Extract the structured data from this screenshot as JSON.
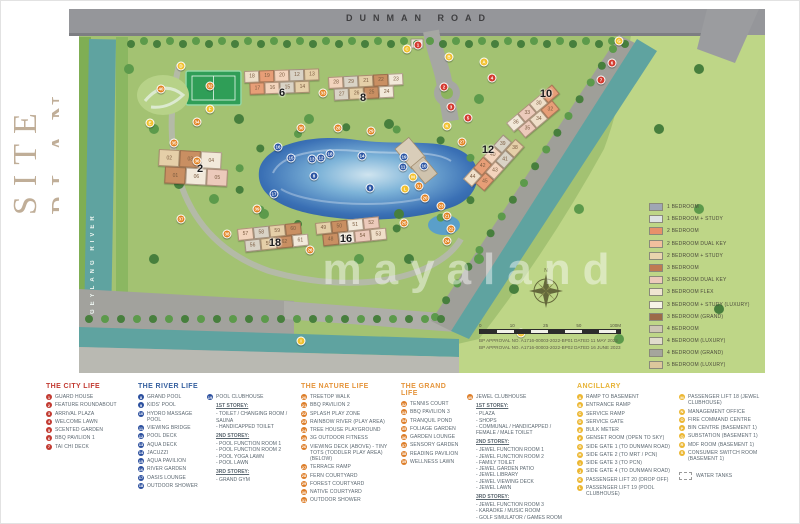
{
  "title": "SITE PLAN",
  "map": {
    "road_label": "DUNMAN ROAD",
    "river_label": "GEYLANG RIVER",
    "watermark": "mayaland",
    "scale_ticks": [
      "0",
      "10",
      "25",
      "50",
      "100M"
    ],
    "approval_lines": [
      "BP APPROVAL NO. A1716-00003-2022-BP01 DATED 11 MAY 2023",
      "BP APPROVAL NO. A1716-00003-2022-BP02 DATED 16 JUNE 2023"
    ],
    "unit_legend": [
      {
        "label": "1 BEDROOM",
        "color": "#9fa6b4"
      },
      {
        "label": "1 BEDROOM + STUDY",
        "color": "#dde2e3"
      },
      {
        "label": "2 BEDROOM",
        "color": "#e8906a"
      },
      {
        "label": "2 BEDROOM DUAL KEY",
        "color": "#f2bf9e"
      },
      {
        "label": "2 BEDROOM + STUDY",
        "color": "#e9d4ae"
      },
      {
        "label": "3 BEDROOM",
        "color": "#bf7a52"
      },
      {
        "label": "3 BEDROOM DUAL KEY",
        "color": "#eccabb"
      },
      {
        "label": "3 BEDROOM FLEX",
        "color": "#efe5d2"
      },
      {
        "label": "3 BEDROOM + STUDY (LUXURY)",
        "color": "#f7f3e8"
      },
      {
        "label": "3 BEDROOM (GRAND)",
        "color": "#9c6b49"
      },
      {
        "label": "4 BEDROOM",
        "color": "#cdc6b4"
      },
      {
        "label": "4 BEDROOM (LUXURY)",
        "color": "#e0dccc"
      },
      {
        "label": "4 BEDROOM (GRAND)",
        "color": "#a5a59d"
      },
      {
        "label": "5 BEDROOM (LUXURY)",
        "color": "#dcc79c"
      },
      {
        "label": "5 BEDROOM (GRAND)",
        "color": "#c8a469"
      },
      {
        "label": "PENTHOUSE",
        "color": "#f1e5ab"
      }
    ],
    "block_labels": [
      {
        "text": "2",
        "x": 141,
        "y": 160
      },
      {
        "text": "6",
        "x": 223,
        "y": 84
      },
      {
        "text": "8",
        "x": 304,
        "y": 89
      },
      {
        "text": "10",
        "x": 487,
        "y": 85
      },
      {
        "text": "12",
        "x": 429,
        "y": 141
      },
      {
        "text": "18",
        "x": 216,
        "y": 234
      },
      {
        "text": "16",
        "x": 287,
        "y": 230
      }
    ],
    "towers": [
      {
        "x": 185,
        "y": 62,
        "rot": -2,
        "bw": 15,
        "bh": 12,
        "rows": [
          [
            "18",
            "19",
            "20",
            "12",
            "13"
          ],
          [
            "17",
            "16",
            "15",
            "14"
          ]
        ]
      },
      {
        "x": 269,
        "y": 68,
        "rot": -3,
        "bw": 15,
        "bh": 12,
        "rows": [
          [
            "28",
            "29",
            "21",
            "22",
            "23"
          ],
          [
            "27",
            "26",
            "25",
            "24"
          ]
        ]
      },
      {
        "x": 100,
        "y": 140,
        "rot": 3,
        "bw": 21,
        "bh": 17,
        "rows": [
          [
            "02",
            "03",
            "04"
          ],
          [
            "01",
            "06",
            "05"
          ]
        ]
      },
      {
        "x": 447,
        "y": 114,
        "rot": -40,
        "bw": 15,
        "bh": 12,
        "rows": [
          [
            "36",
            "33",
            "30",
            "31"
          ],
          [
            "35",
            "34",
            "32"
          ]
        ]
      },
      {
        "x": 404,
        "y": 170,
        "rot": -48,
        "bw": 15,
        "bh": 12,
        "rows": [
          [
            "44",
            "42",
            "40",
            "39"
          ],
          [
            "45",
            "43",
            "41",
            "38"
          ]
        ]
      },
      {
        "x": 178,
        "y": 220,
        "rot": -6,
        "bw": 16,
        "bh": 12,
        "rows": [
          [
            "57",
            "58",
            "59",
            "60"
          ],
          [
            "56",
            "55",
            "62",
            "61"
          ]
        ]
      },
      {
        "x": 256,
        "y": 214,
        "rot": -6,
        "bw": 16,
        "bh": 12,
        "rows": [
          [
            "49",
            "50",
            "51",
            "52"
          ],
          [
            "48",
            "47",
            "54",
            "53"
          ]
        ]
      }
    ],
    "markers": [
      {
        "c": "r",
        "t": "1",
        "x": 359,
        "y": 36
      },
      {
        "c": "r",
        "t": "2",
        "x": 385,
        "y": 78
      },
      {
        "c": "r",
        "t": "3",
        "x": 392,
        "y": 98
      },
      {
        "c": "r",
        "t": "4",
        "x": 433,
        "y": 69
      },
      {
        "c": "r",
        "t": "5",
        "x": 409,
        "y": 109
      },
      {
        "c": "r",
        "t": "6",
        "x": 553,
        "y": 54
      },
      {
        "c": "r",
        "t": "7",
        "x": 542,
        "y": 71
      },
      {
        "c": "b",
        "t": "8",
        "x": 255,
        "y": 167
      },
      {
        "c": "b",
        "t": "9",
        "x": 311,
        "y": 179
      },
      {
        "c": "b",
        "t": "10",
        "x": 365,
        "y": 157
      },
      {
        "c": "b",
        "t": "11",
        "x": 344,
        "y": 158
      },
      {
        "c": "b",
        "t": "12",
        "x": 262,
        "y": 149
      },
      {
        "c": "b",
        "t": "13",
        "x": 253,
        "y": 150
      },
      {
        "c": "b",
        "t": "14",
        "x": 303,
        "y": 147
      },
      {
        "c": "b",
        "t": "15",
        "x": 232,
        "y": 149
      },
      {
        "c": "b",
        "t": "16",
        "x": 219,
        "y": 138
      },
      {
        "c": "b",
        "t": "17",
        "x": 215,
        "y": 185
      },
      {
        "c": "b",
        "t": "18",
        "x": 271,
        "y": 145
      },
      {
        "c": "b",
        "t": "19",
        "x": 345,
        "y": 148
      },
      {
        "c": "o",
        "t": "20",
        "x": 366,
        "y": 189
      },
      {
        "c": "o",
        "t": "21",
        "x": 388,
        "y": 207
      },
      {
        "c": "o",
        "t": "22",
        "x": 392,
        "y": 220
      },
      {
        "c": "o",
        "t": "23",
        "x": 382,
        "y": 197
      },
      {
        "c": "o",
        "t": "24",
        "x": 388,
        "y": 232
      },
      {
        "c": "o",
        "t": "25",
        "x": 345,
        "y": 214
      },
      {
        "c": "o",
        "t": "26",
        "x": 251,
        "y": 241
      },
      {
        "c": "o",
        "t": "27",
        "x": 403,
        "y": 133
      },
      {
        "c": "o",
        "t": "28",
        "x": 279,
        "y": 119
      },
      {
        "c": "o",
        "t": "29",
        "x": 312,
        "y": 122
      },
      {
        "c": "o",
        "t": "30",
        "x": 242,
        "y": 119
      },
      {
        "c": "o",
        "t": "31",
        "x": 360,
        "y": 177
      },
      {
        "c": "o",
        "t": "32",
        "x": 151,
        "y": 77
      },
      {
        "c": "o",
        "t": "33",
        "x": 264,
        "y": 84
      },
      {
        "c": "o",
        "t": "34",
        "x": 138,
        "y": 113
      },
      {
        "c": "o",
        "t": "35",
        "x": 115,
        "y": 134
      },
      {
        "c": "o",
        "t": "36",
        "x": 138,
        "y": 152
      },
      {
        "c": "o",
        "t": "37",
        "x": 122,
        "y": 210
      },
      {
        "c": "o",
        "t": "38",
        "x": 168,
        "y": 225
      },
      {
        "c": "o",
        "t": "39",
        "x": 198,
        "y": 200
      },
      {
        "c": "o",
        "t": "40",
        "x": 102,
        "y": 80
      },
      {
        "c": "y",
        "t": "A",
        "x": 425,
        "y": 53
      },
      {
        "c": "y",
        "t": "B",
        "x": 390,
        "y": 48
      },
      {
        "c": "y",
        "t": "C",
        "x": 348,
        "y": 40
      },
      {
        "c": "y",
        "t": "D",
        "x": 122,
        "y": 57
      },
      {
        "c": "y",
        "t": "E",
        "x": 91,
        "y": 114
      },
      {
        "c": "y",
        "t": "F",
        "x": 151,
        "y": 100
      },
      {
        "c": "y",
        "t": "G",
        "x": 560,
        "y": 32
      },
      {
        "c": "y",
        "t": "H",
        "x": 462,
        "y": 324
      },
      {
        "c": "y",
        "t": "I",
        "x": 242,
        "y": 332
      },
      {
        "c": "y",
        "t": "K",
        "x": 388,
        "y": 117
      },
      {
        "c": "y",
        "t": "L",
        "x": 346,
        "y": 180
      },
      {
        "c": "y",
        "t": "M",
        "x": 354,
        "y": 168
      }
    ]
  },
  "legend": {
    "city": {
      "heading": "THE CITY LIFE",
      "items": [
        {
          "n": "1",
          "label": "GUARD HOUSE"
        },
        {
          "n": "2",
          "label": "FEATURE ROUNDABOUT"
        },
        {
          "n": "3",
          "label": "ARRIVAL PLAZA"
        },
        {
          "n": "4",
          "label": "WELCOME LAWN"
        },
        {
          "n": "5",
          "label": "SCENTED GARDEN"
        },
        {
          "n": "6",
          "label": "BBQ PAVILION 1"
        },
        {
          "n": "7",
          "label": "TAI CHI DECK"
        }
      ]
    },
    "river": {
      "heading": "THE RIVER LIFE",
      "items": [
        {
          "n": "8",
          "label": "GRAND POOL"
        },
        {
          "n": "9",
          "label": "KIDS' POOL"
        },
        {
          "n": "10",
          "label": "HYDRO MASSAGE POOL"
        },
        {
          "n": "11",
          "label": "VIEWING BRIDGE"
        },
        {
          "n": "12",
          "label": "POOL DECK"
        },
        {
          "n": "13",
          "label": "AQUA DECK"
        },
        {
          "n": "14",
          "label": "JACUZZI"
        },
        {
          "n": "15",
          "label": "AQUA PAVILION"
        },
        {
          "n": "16",
          "label": "RIVER GARDEN"
        },
        {
          "n": "17",
          "label": "OASIS LOUNGE"
        },
        {
          "n": "18",
          "label": "OUTDOOR SHOWER"
        }
      ]
    },
    "pool_clubhouse": {
      "n": "19",
      "title": "POOL CLUBHOUSE",
      "sections": [
        {
          "heading": "1ST STOREY:",
          "items": [
            "TOILET / CHANGING ROOM / SAUNA",
            "HANDICAPPED TOILET"
          ]
        },
        {
          "heading": "2ND STOREY:",
          "items": [
            "POOL FUNCTION ROOM 1",
            "POOL FUNCTION ROOM 2",
            "POOL YOGA LAWN",
            "POOL LAWN"
          ]
        },
        {
          "heading": "3RD STOREY:",
          "items": [
            "GRAND GYM"
          ]
        }
      ]
    },
    "nature": {
      "heading": "THE NATURE LIFE",
      "items": [
        {
          "n": "20",
          "label": "TREETOP WALK"
        },
        {
          "n": "21",
          "label": "BBQ PAVILION 2"
        },
        {
          "n": "22",
          "label": "SPLASH PLAY ZONE"
        },
        {
          "n": "23",
          "label": "RAINBOW RIVER (PLAY AREA)"
        },
        {
          "n": "24",
          "label": "TREE HOUSE PLAYGROUND"
        },
        {
          "n": "25",
          "label": "3G OUTDOOR FITNESS"
        },
        {
          "n": "26",
          "label": "VIEWING DECK (ABOVE) - TINY TOTS (TODDLER PLAY AREA)(BELOW)"
        },
        {
          "n": "27",
          "label": "TERRACE RAMP"
        },
        {
          "n": "28",
          "label": "FERN COURTYARD"
        },
        {
          "n": "29",
          "label": "FOREST COURTYARD"
        },
        {
          "n": "30",
          "label": "NATIVE COURTYARD"
        },
        {
          "n": "31",
          "label": "OUTDOOR SHOWER"
        }
      ]
    },
    "grand": {
      "heading": "THE GRAND LIFE",
      "items": [
        {
          "n": "32",
          "label": "TENNIS COURT"
        },
        {
          "n": "33",
          "label": "BBQ PAVILION 3"
        },
        {
          "n": "34",
          "label": "TRANQUIL POND"
        },
        {
          "n": "35",
          "label": "FOLIAGE GARDEN"
        },
        {
          "n": "36",
          "label": "GARDEN LOUNGE"
        },
        {
          "n": "37",
          "label": "SENSORY GARDEN"
        },
        {
          "n": "38",
          "label": "READING PAVILION"
        },
        {
          "n": "39",
          "label": "WELLNESS LAWN"
        }
      ]
    },
    "jewel_clubhouse": {
      "n": "40",
      "title": "JEWEL CLUBHOUSE",
      "sections": [
        {
          "heading": "1ST STOREY:",
          "items": [
            "PLAZA",
            "SHOPS",
            "COMMUNAL / HANDICAPPED / FEMALE / MALE TOILET"
          ]
        },
        {
          "heading": "2ND STOREY:",
          "items": [
            "JEWEL FUNCTION ROOM 1",
            "JEWEL FUNCTION ROOM 2",
            "FAMILY TOILET",
            "JEWEL GARDEN PATIO",
            "JEWEL LIBRARY",
            "JEWEL VIEWING DECK",
            "JEWEL LAWN"
          ]
        },
        {
          "heading": "3RD STOREY:",
          "items": [
            "JEWEL FUNCTION ROOM 3",
            "KARAOKE / MUSIC ROOM",
            "GOLF SIMULATOR / GAMES ROOM"
          ]
        }
      ]
    },
    "ancillary": {
      "heading": "ANCILLARY",
      "items": [
        {
          "n": "A",
          "label": "RAMP TO BASEMENT"
        },
        {
          "n": "B",
          "label": "ENTRANCE RAMP"
        },
        {
          "n": "C",
          "label": "SERVICE RAMP"
        },
        {
          "n": "D",
          "label": "SERVICE GATE"
        },
        {
          "n": "E",
          "label": "BULK METER"
        },
        {
          "n": "F",
          "label": "GENSET ROOM (OPEN TO SKY)"
        },
        {
          "n": "G",
          "label": "SIDE GATE 1 (TO DUNMAN ROAD)"
        },
        {
          "n": "H",
          "label": "SIDE GATE 2 (TO MRT / PCN)"
        },
        {
          "n": "I",
          "label": "SIDE GATE 3 (TO PCN)"
        },
        {
          "n": "J",
          "label": "SIDE GATE 4 (TO DUNMAN ROAD)"
        },
        {
          "n": "K",
          "label": "PASSENGER LIFT 20 (DROP OFF)"
        },
        {
          "n": "L",
          "label": "PASSENGER LIFT 19 (POOL CLUBHOUSE)"
        }
      ]
    },
    "ancillary2": {
      "items": [
        {
          "n": "M",
          "label": "PASSENGER LIFT 18 (JEWEL CLUBHOUSE)"
        },
        {
          "n": "N",
          "label": "MANAGEMENT OFFICE"
        },
        {
          "n": "O",
          "label": "FIRE COMMAND CENTRE"
        },
        {
          "n": "P",
          "label": "BIN CENTRE (BASEMENT 1)"
        },
        {
          "n": "Q",
          "label": "SUBSTATION (BASEMENT 1)"
        },
        {
          "n": "R",
          "label": "MDF ROOM (BASEMENT 1)"
        },
        {
          "n": "S",
          "label": "CONSUMER SWITCH ROOM (BASEMENT 1)"
        }
      ],
      "water_tanks": "WATER TANKS"
    }
  }
}
